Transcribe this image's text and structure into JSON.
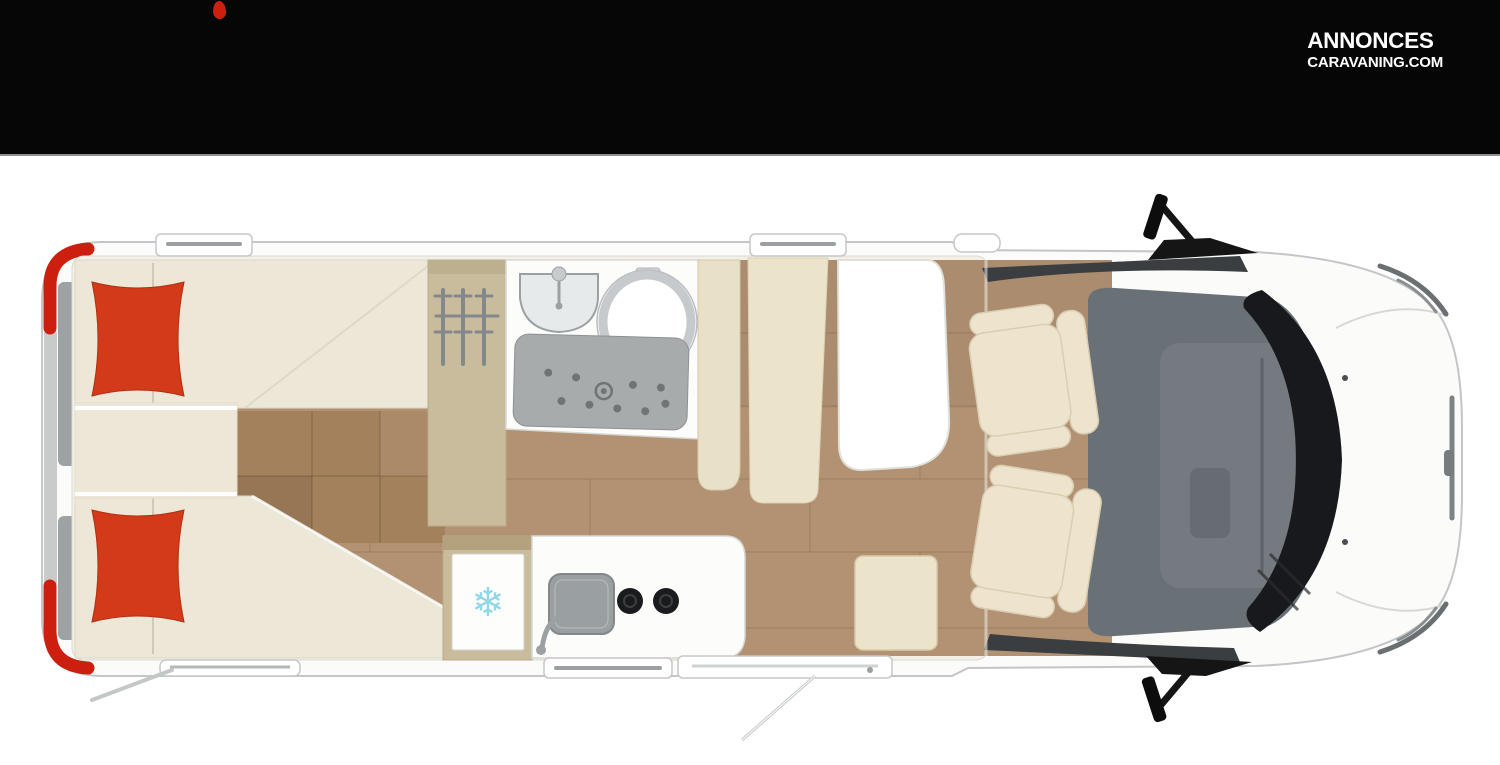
{
  "header": {
    "logo_line1": "ANNONCES",
    "logo_line2": "CARAVANING.COM"
  },
  "floorplan": {
    "fridge_symbol": "❄"
  },
  "colors": {
    "header_bg": "#060606",
    "logo_text": "#ffffff",
    "accent_red": "#cc1f10",
    "page_bg": "#ffffff",
    "body_white": "#fbfbfa",
    "outline_gray": "#c3c6c6",
    "interior_cream": "#f3f0e8",
    "bed_cream": "#ece7d7",
    "pillow_red": "#d23a19",
    "wood_floor": "#b29273",
    "wood_line": "#8a6c4d",
    "step_wood": "#a3815d",
    "wardrobe_tan": "#c9bc9c",
    "dinette_cream": "#ece3cb",
    "table_white": "#ffffff",
    "shower_gray": "#a7abac",
    "fixture_gray": "#9aa0a4",
    "dash_gray": "#697076",
    "glass_black": "#17191c",
    "seat_cream": "#eee4cd",
    "snowflake_blue": "#8fd8e8",
    "divider_gray": "#9da2a4"
  }
}
